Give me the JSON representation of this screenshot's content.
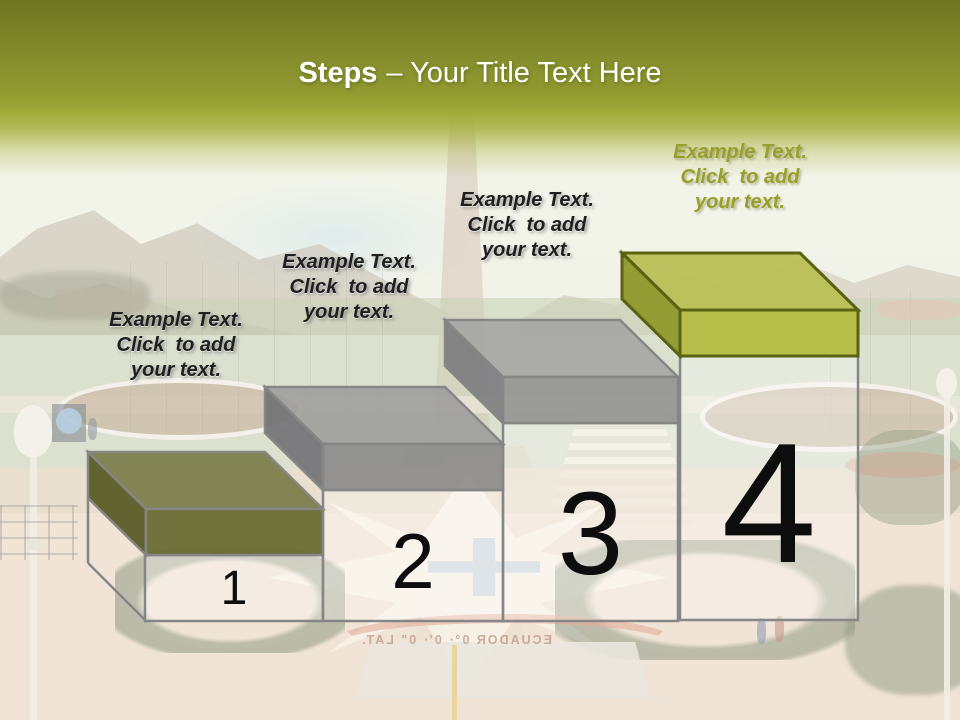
{
  "title": {
    "emphasis": "Steps",
    "rest": "– Your Title Text Here"
  },
  "colors": {
    "band_dark": "#6e7520",
    "band_light": "#9aa436",
    "frame": "#868686",
    "column_fill": "rgba(255,255,255,0.30)",
    "number_text": "#0d0d0d",
    "placeholder_text": "#1f1f1f",
    "placeholder_text_step4": "#96a02a",
    "title_text": "#ffffff"
  },
  "steps": {
    "items": [
      {
        "number": "1",
        "placeholder": "Example Text.\nClick  to add\nyour text.",
        "slab": {
          "top": "#787c4a",
          "side": "#555922",
          "front": "#65692e",
          "outline": "#868686"
        }
      },
      {
        "number": "2",
        "placeholder": "Example Text.\nClick  to add\nyour text.",
        "slab": {
          "top": "#9d9d9b",
          "side": "#717174",
          "front": "#8a8a8a",
          "outline": "#868686"
        }
      },
      {
        "number": "3",
        "placeholder": "Example Text.\nClick  to add\nyour text.",
        "slab": {
          "top": "#a5a5a3",
          "side": "#7b7b7e",
          "front": "#929292",
          "outline": "#868686"
        }
      },
      {
        "number": "4",
        "placeholder": "Example Text.\nClick  to add\nyour text.",
        "slab": {
          "top": "#b9c157",
          "side": "#8f992c",
          "front": "#b5bd45",
          "outline": "#5a6213"
        }
      }
    ]
  },
  "photo": {
    "mirrored_caption": "ECUADOR   0°· 0'· 0\" LAT."
  }
}
